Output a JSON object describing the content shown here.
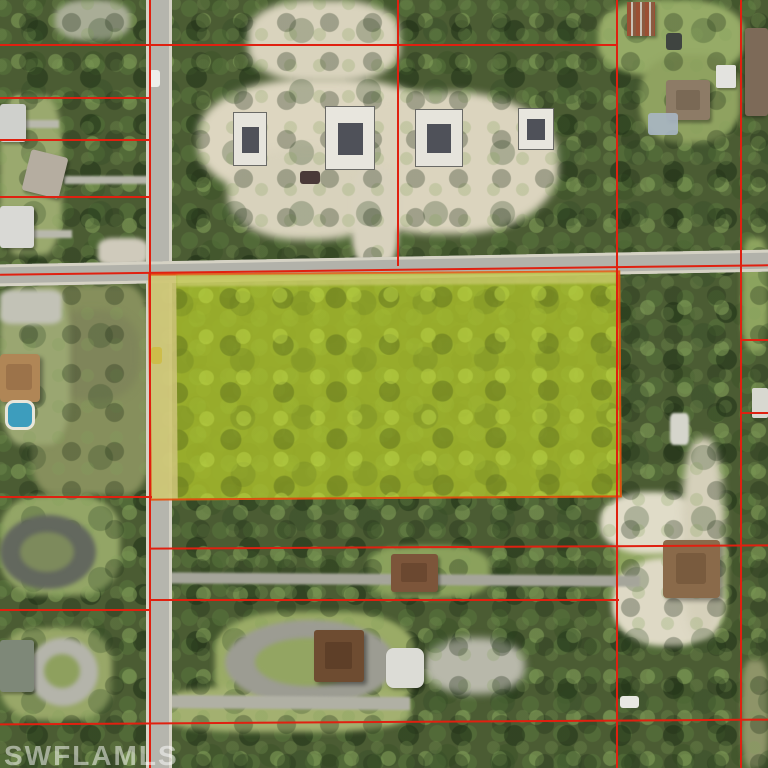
{
  "watermark": {
    "text": "SWFLAMLS"
  },
  "map": {
    "kind": "aerial-parcel-map",
    "subject": "yellow-highlighted wooded parcel at road intersection",
    "palette": {
      "boundary_red": "#e02010",
      "highlight_border_orange": "#e8500e",
      "highlight_yellow_green": "#9fb32b",
      "road_gray": "#b4b4ac",
      "sand": "#ddd6c0",
      "forest_green": "#4b5c33",
      "pool_blue": "#3d9dbd"
    }
  },
  "layers": {
    "patches": [
      {
        "name": "lawn-top-right",
        "x": 598,
        "y": 0,
        "w": 146,
        "h": 76,
        "color": "#96ab67",
        "rad": "40%",
        "blur": 3
      },
      {
        "name": "lawn-right-mid",
        "x": 640,
        "y": 55,
        "w": 100,
        "h": 88,
        "color": "#8fa260",
        "rad": "40%",
        "blur": 3
      },
      {
        "name": "lawn-left-homes",
        "x": 0,
        "y": 95,
        "w": 62,
        "h": 160,
        "color": "#9aa96e",
        "rad": "30%",
        "blur": 3
      },
      {
        "name": "clearing-top-left",
        "x": 55,
        "y": 0,
        "w": 75,
        "h": 40,
        "color": "#a9ad96",
        "rad": "40%",
        "blur": 3
      },
      {
        "name": "scrub-field-left",
        "x": 30,
        "y": 285,
        "w": 120,
        "h": 210,
        "color": "#868f5c",
        "rad": "20%",
        "blur": 3
      },
      {
        "name": "scrub-brown-patch",
        "x": 45,
        "y": 310,
        "w": 95,
        "h": 90,
        "color": "#7f855a",
        "rad": "40%",
        "blur": 4
      },
      {
        "name": "yard-house-tan",
        "x": 0,
        "y": 285,
        "w": 70,
        "h": 160,
        "color": "#9aa671",
        "rad": "30%",
        "blur": 3
      },
      {
        "name": "lawn-bottom-left-1",
        "x": 0,
        "y": 495,
        "w": 120,
        "h": 100,
        "color": "#93a566",
        "rad": "35%",
        "blur": 3
      },
      {
        "name": "lawn-bottom-left-2",
        "x": 0,
        "y": 628,
        "w": 112,
        "h": 92,
        "color": "#98a768",
        "rad": "35%",
        "blur": 3
      },
      {
        "name": "lawn-bottom-center",
        "x": 215,
        "y": 612,
        "w": 200,
        "h": 104,
        "color": "#9aab66",
        "rad": "35%",
        "blur": 3
      },
      {
        "name": "lawn-bottom-road-side",
        "x": 158,
        "y": 686,
        "w": 252,
        "h": 46,
        "color": "#a3b070",
        "rad": "35%",
        "blur": 3
      },
      {
        "name": "lawn-house-east",
        "x": 615,
        "y": 518,
        "w": 112,
        "h": 122,
        "color": "#8fa55e",
        "rad": "35%",
        "blur": 3
      },
      {
        "name": "lawn-house-mid",
        "x": 368,
        "y": 546,
        "w": 122,
        "h": 52,
        "color": "#8ba15c",
        "rad": "35%",
        "blur": 3
      },
      {
        "name": "lawn-right-column",
        "x": 742,
        "y": 238,
        "w": 26,
        "h": 112,
        "color": "#8ea45f",
        "rad": "30%",
        "blur": 3
      },
      {
        "name": "scrub-right-column-bottom",
        "x": 742,
        "y": 660,
        "w": 26,
        "h": 108,
        "color": "#8e9468",
        "rad": "30%",
        "blur": 3
      },
      {
        "name": "cleared-sand-main-west",
        "x": 198,
        "y": 78,
        "w": 252,
        "h": 124,
        "color": "#ddd6c0",
        "rad": "45%",
        "blur": 4
      },
      {
        "name": "cleared-sand-main-east",
        "x": 330,
        "y": 92,
        "w": 228,
        "h": 142,
        "color": "#dbd4be",
        "rad": "45%",
        "blur": 4
      },
      {
        "name": "cleared-sand-south-lobe",
        "x": 228,
        "y": 148,
        "w": 162,
        "h": 92,
        "color": "#d8d2bc",
        "rad": "45%",
        "blur": 4
      },
      {
        "name": "cleared-sand-top-strip",
        "x": 248,
        "y": 0,
        "w": 152,
        "h": 82,
        "color": "#d9d3bd",
        "rad": "40%",
        "blur": 4
      },
      {
        "name": "sand-construction-drive",
        "x": 352,
        "y": 168,
        "w": 46,
        "h": 98,
        "color": "#d8d2be",
        "rad": "30%",
        "blur": 3
      },
      {
        "name": "sand-bottom-right-1",
        "x": 600,
        "y": 492,
        "w": 102,
        "h": 62,
        "color": "#e0dcc8",
        "rad": "45%",
        "blur": 3
      },
      {
        "name": "sand-bottom-right-2",
        "x": 612,
        "y": 558,
        "w": 112,
        "h": 88,
        "color": "#ded9c5",
        "rad": "45%",
        "blur": 3
      },
      {
        "name": "sand-trail-right",
        "x": 682,
        "y": 438,
        "w": 42,
        "h": 200,
        "color": "#d5d0ba",
        "rad": "40%",
        "blur": 4
      },
      {
        "name": "gravel-rv-yard",
        "x": 425,
        "y": 638,
        "w": 100,
        "h": 56,
        "color": "#b8b8aa",
        "rad": "45%",
        "blur": 4
      }
    ],
    "driveways": [
      {
        "name": "dark-loop-drive-outer",
        "x": 0,
        "y": 515,
        "w": 96,
        "h": 74,
        "color": "#63685e",
        "rad": "50%",
        "blur": 2
      },
      {
        "name": "dark-loop-drive-infield",
        "x": 20,
        "y": 532,
        "w": 54,
        "h": 40,
        "color": "#7d8a5c",
        "rad": "50%",
        "blur": 2
      },
      {
        "name": "light-loop-drive-outer",
        "x": 28,
        "y": 638,
        "w": 70,
        "h": 68,
        "color": "#b4b4aa",
        "rad": "50%",
        "blur": 2
      },
      {
        "name": "light-loop-drive-infield",
        "x": 44,
        "y": 654,
        "w": 36,
        "h": 34,
        "color": "#8ea05e",
        "rad": "50%",
        "blur": 2
      },
      {
        "name": "circular-drive-outer",
        "x": 225,
        "y": 620,
        "w": 170,
        "h": 85,
        "color": "#9c9c92",
        "rad": "50%",
        "blur": 2
      },
      {
        "name": "circular-drive-infield",
        "x": 255,
        "y": 638,
        "w": 106,
        "h": 48,
        "color": "#93a562",
        "rad": "50%",
        "blur": 2
      },
      {
        "name": "east-west-track",
        "x": 160,
        "y": 574,
        "w": 480,
        "h": 11,
        "color": "#a5a59a",
        "rot": 0.4,
        "blur": 1
      },
      {
        "name": "bottom-gray-path",
        "x": 160,
        "y": 696,
        "w": 250,
        "h": 13,
        "color": "#b0b0a4",
        "rot": 0.5,
        "blur": 1
      },
      {
        "name": "driveway-left-home-2",
        "x": 64,
        "y": 176,
        "w": 84,
        "h": 8,
        "color": "#b5b5a9",
        "blur": 1
      },
      {
        "name": "driveway-left-home-1",
        "x": 25,
        "y": 120,
        "w": 34,
        "h": 8,
        "color": "#b8b8ac",
        "blur": 1
      },
      {
        "name": "driveway-left-home-3",
        "x": 28,
        "y": 230,
        "w": 44,
        "h": 8,
        "color": "#b8b8ac",
        "blur": 1
      },
      {
        "name": "driveway-tan-house",
        "x": 0,
        "y": 290,
        "w": 62,
        "h": 34,
        "color": "#c2c2b6",
        "rad": "20%",
        "blur": 2
      },
      {
        "name": "intersection-corner-pad",
        "x": 98,
        "y": 238,
        "w": 50,
        "h": 28,
        "color": "#cfcabb",
        "rad": "30%",
        "blur": 2
      }
    ],
    "roads": [
      {
        "name": "vertical-road",
        "x": 146,
        "y": 0,
        "w": 26,
        "h": 768,
        "color": "#b5b5ad",
        "shadow": "inset 3px 0 0 rgba(221,218,203,0.8), inset -3px 0 0 rgba(221,218,203,0.8)"
      },
      {
        "name": "horizontal-road",
        "x": -4,
        "y": 257,
        "w": 776,
        "h": 22,
        "color": "#b2b2aa",
        "rot": -1.1,
        "shadow": "inset 0 3px 0 rgba(221,218,203,0.8), inset 0 -3px 0 rgba(221,218,203,0.8)"
      }
    ],
    "highlight_parcel": {
      "name": "highlighted-parcel",
      "x": 149,
      "y": 272,
      "w": 468,
      "h": 223,
      "rot": -0.4,
      "cls": "parcel-tex",
      "op": 0.92,
      "border": "2px solid #e8500e",
      "children": [
        {
          "name": "parcel-road-frontage-strip",
          "x": 0,
          "y": 0,
          "w": 26,
          "h": 223,
          "color": "#d2c878",
          "op": 0.95
        },
        {
          "name": "parcel-north-shoulder",
          "x": 26,
          "y": 0,
          "w": 440,
          "h": 11,
          "color": "#cfd06e",
          "op": 0.8,
          "blur": 1
        }
      ]
    },
    "foundations": [
      {
        "name": "foundation-slab-1",
        "x": 233,
        "y": 112,
        "w": 32,
        "h": 52,
        "color": "#e6e4dc",
        "border": "1px solid #6a6a66",
        "children": [
          {
            "name": "slab-forms",
            "x": 8,
            "y": 14,
            "w": 17,
            "h": 26,
            "color": "#4f5159"
          }
        ]
      },
      {
        "name": "foundation-slab-2",
        "x": 325,
        "y": 106,
        "w": 48,
        "h": 62,
        "color": "#e8e6de",
        "border": "1px solid #6a6a66",
        "children": [
          {
            "name": "slab-forms",
            "x": 12,
            "y": 16,
            "w": 25,
            "h": 32,
            "color": "#4f5159"
          }
        ]
      },
      {
        "name": "foundation-slab-3",
        "x": 415,
        "y": 109,
        "w": 46,
        "h": 56,
        "color": "#e6e4dc",
        "border": "1px solid #6a6a66",
        "children": [
          {
            "name": "slab-forms",
            "x": 11,
            "y": 14,
            "w": 24,
            "h": 29,
            "color": "#4f5159"
          }
        ]
      },
      {
        "name": "foundation-slab-4",
        "x": 518,
        "y": 108,
        "w": 34,
        "h": 40,
        "color": "#e8e6de",
        "border": "1px solid #6a6a66",
        "children": [
          {
            "name": "slab-forms",
            "x": 8,
            "y": 10,
            "w": 18,
            "h": 21,
            "color": "#4f5159"
          }
        ]
      }
    ],
    "buildings": [
      {
        "name": "house-left-1",
        "x": 0,
        "y": 104,
        "w": 26,
        "h": 38,
        "color": "#cfd0cc",
        "rad": "3px",
        "shadow": "2px 2px 3px rgba(0,0,0,0.35)"
      },
      {
        "name": "house-left-2",
        "x": 26,
        "y": 153,
        "w": 38,
        "h": 42,
        "color": "#b5ada0",
        "rot": 14,
        "rad": "3px",
        "shadow": "2px 2px 3px rgba(0,0,0,0.35)"
      },
      {
        "name": "house-left-3",
        "x": 0,
        "y": 206,
        "w": 34,
        "h": 42,
        "color": "#d9d9d5",
        "rad": "3px",
        "shadow": "2px 2px 3px rgba(0,0,0,0.35)"
      },
      {
        "name": "house-rust-metal-roof",
        "x": 627,
        "y": 2,
        "w": 28,
        "h": 34,
        "bg": "repeating-linear-gradient(90deg,#9a4f33 0 4px,#c8c0b4 4px 6px,#8a5a40 6px 9px)",
        "shadow": "2px 2px 3px rgba(0,0,0,0.35)"
      },
      {
        "name": "house-right-edge",
        "x": 745,
        "y": 28,
        "w": 23,
        "h": 88,
        "color": "#7d6a58",
        "rad": "3px",
        "shadow": "-2px 2px 3px rgba(0,0,0,0.3)"
      },
      {
        "name": "house-right-hip-roof",
        "x": 666,
        "y": 80,
        "w": 44,
        "h": 40,
        "color": "#8d7b66",
        "rad": "3px",
        "shadow": "2px 3px 3px rgba(0,0,0,0.35)",
        "children": [
          {
            "name": "roof-ridge",
            "x": 10,
            "y": 10,
            "w": 24,
            "h": 20,
            "color": "#7a6955",
            "rad": "2px"
          }
        ]
      },
      {
        "name": "shed-white",
        "x": 716,
        "y": 65,
        "w": 20,
        "h": 23,
        "color": "#e3e3df",
        "rad": "2px",
        "shadow": "1px 2px 2px rgba(0,0,0,0.3)"
      },
      {
        "name": "tarp-structure-blue",
        "x": 648,
        "y": 113,
        "w": 30,
        "h": 22,
        "color": "#a9b6c4",
        "rad": "3px",
        "op": 0.9
      },
      {
        "name": "house-tan-tile-roof",
        "x": 0,
        "y": 354,
        "w": 40,
        "h": 48,
        "color": "#b08656",
        "rad": "4px",
        "shadow": "3px 3px 4px rgba(0,0,0,0.35)",
        "children": [
          {
            "name": "roof-ridge",
            "x": 6,
            "y": 10,
            "w": 26,
            "h": 26,
            "color": "#9c734a",
            "rad": "3px"
          }
        ]
      },
      {
        "name": "swimming-pool",
        "x": 5,
        "y": 400,
        "w": 24,
        "h": 24,
        "color": "#3d9dbd",
        "rad": "30%",
        "border": "3px solid #e8e6da"
      },
      {
        "name": "house-mid-brown-roof",
        "x": 391,
        "y": 554,
        "w": 47,
        "h": 38,
        "color": "#7c553a",
        "rad": "3px",
        "shadow": "2px 3px 3px rgba(0,0,0,0.35)",
        "children": [
          {
            "name": "roof-ridge",
            "x": 10,
            "y": 9,
            "w": 26,
            "h": 19,
            "color": "#6b4830",
            "rad": "2px"
          }
        ]
      },
      {
        "name": "house-bottom-center-dark",
        "x": 314,
        "y": 630,
        "w": 50,
        "h": 52,
        "color": "#6e4c31",
        "rad": "3px",
        "shadow": "3px 3px 4px rgba(0,0,0,0.4)",
        "children": [
          {
            "name": "roof-ridge",
            "x": 11,
            "y": 12,
            "w": 27,
            "h": 27,
            "color": "#5e3f28",
            "rad": "2px"
          }
        ]
      },
      {
        "name": "house-bottom-right-hip",
        "x": 663,
        "y": 540,
        "w": 57,
        "h": 58,
        "color": "#8a6a4a",
        "rad": "4px",
        "shadow": "3px 3px 4px rgba(0,0,0,0.35)",
        "children": [
          {
            "name": "roof-ridge",
            "x": 13,
            "y": 13,
            "w": 30,
            "h": 31,
            "color": "#795b3e",
            "rad": "3px"
          }
        ]
      },
      {
        "name": "house-bottom-left-gray",
        "x": 0,
        "y": 640,
        "w": 34,
        "h": 52,
        "color": "#7e8878",
        "rad": "3px",
        "shadow": "2px 2px 3px rgba(0,0,0,0.35)"
      },
      {
        "name": "rv-boat-cluster",
        "x": 386,
        "y": 648,
        "w": 38,
        "h": 40,
        "color": "#dcdcd6",
        "rad": "20%",
        "shadow": "2px 2px 3px rgba(0,0,0,0.3)"
      },
      {
        "name": "white-shed-right-column",
        "x": 752,
        "y": 388,
        "w": 16,
        "h": 30,
        "color": "#d8d8d0",
        "rad": "2px"
      },
      {
        "name": "white-debris-mid-east",
        "x": 670,
        "y": 413,
        "w": 19,
        "h": 32,
        "color": "#d5d5cc",
        "rad": "20%",
        "blur": 1
      }
    ],
    "vehicles": [
      {
        "name": "white-car-on-road-north",
        "x": 149,
        "y": 70,
        "w": 11,
        "h": 17,
        "color": "#eeeeea",
        "rad": "3px"
      },
      {
        "name": "dark-truck-construction",
        "x": 300,
        "y": 171,
        "w": 20,
        "h": 13,
        "color": "#4a3a38",
        "rad": "3px"
      },
      {
        "name": "car-on-road-parcel",
        "x": 151,
        "y": 347,
        "w": 11,
        "h": 17,
        "color": "#cdbd4a",
        "rad": "3px"
      },
      {
        "name": "white-car-bottom-right",
        "x": 620,
        "y": 696,
        "w": 19,
        "h": 12,
        "color": "#e8e8e2",
        "rad": "3px"
      },
      {
        "name": "dark-vehicle-top-right",
        "x": 666,
        "y": 33,
        "w": 16,
        "h": 17,
        "color": "#3f4440",
        "rad": "3px"
      }
    ],
    "boundary_lines": [
      {
        "name": "lot-line-vertical-road-west",
        "x": 149,
        "y": 0,
        "w": 2,
        "h": 768,
        "color": "#e02010"
      },
      {
        "name": "lot-line-vertical-397",
        "x": 397,
        "y": 0,
        "w": 2,
        "h": 266,
        "color": "#e02010"
      },
      {
        "name": "lot-line-vertical-616",
        "x": 616,
        "y": 0,
        "w": 2,
        "h": 768,
        "color": "#e02010"
      },
      {
        "name": "lot-line-vertical-740",
        "x": 740,
        "y": 0,
        "w": 2,
        "h": 768,
        "color": "#e02010"
      },
      {
        "name": "lot-line-h-44",
        "x": 0,
        "y": 44,
        "w": 618,
        "h": 2,
        "color": "#e02010"
      },
      {
        "name": "lot-line-h-97",
        "x": 0,
        "y": 97,
        "w": 150,
        "h": 2,
        "color": "#e02010"
      },
      {
        "name": "lot-line-h-139",
        "x": 0,
        "y": 139,
        "w": 150,
        "h": 2,
        "color": "#e02010"
      },
      {
        "name": "lot-line-h-196",
        "x": 0,
        "y": 196,
        "w": 150,
        "h": 2,
        "color": "#e02010"
      },
      {
        "name": "lot-line-h-road",
        "x": 0,
        "y": 269,
        "w": 768,
        "h": 2,
        "color": "#e02010",
        "rot": -0.7
      },
      {
        "name": "lot-line-h-parcel-south-west",
        "x": 0,
        "y": 496,
        "w": 152,
        "h": 2,
        "color": "#e02010"
      },
      {
        "name": "lot-line-h-546",
        "x": 149,
        "y": 546,
        "w": 619,
        "h": 2,
        "color": "#e02010",
        "rot": -0.3
      },
      {
        "name": "lot-line-h-599",
        "x": 149,
        "y": 599,
        "w": 470,
        "h": 2,
        "color": "#e02010"
      },
      {
        "name": "lot-line-h-609-left",
        "x": 0,
        "y": 609,
        "w": 150,
        "h": 2,
        "color": "#e02010"
      },
      {
        "name": "lot-line-h-721",
        "x": 0,
        "y": 721,
        "w": 768,
        "h": 2,
        "color": "#e02010",
        "rot": -0.35
      },
      {
        "name": "lot-line-h-right-339",
        "x": 740,
        "y": 339,
        "w": 28,
        "h": 2,
        "color": "#e02010"
      },
      {
        "name": "lot-line-h-right-412",
        "x": 740,
        "y": 412,
        "w": 28,
        "h": 2,
        "color": "#e02010"
      }
    ]
  }
}
